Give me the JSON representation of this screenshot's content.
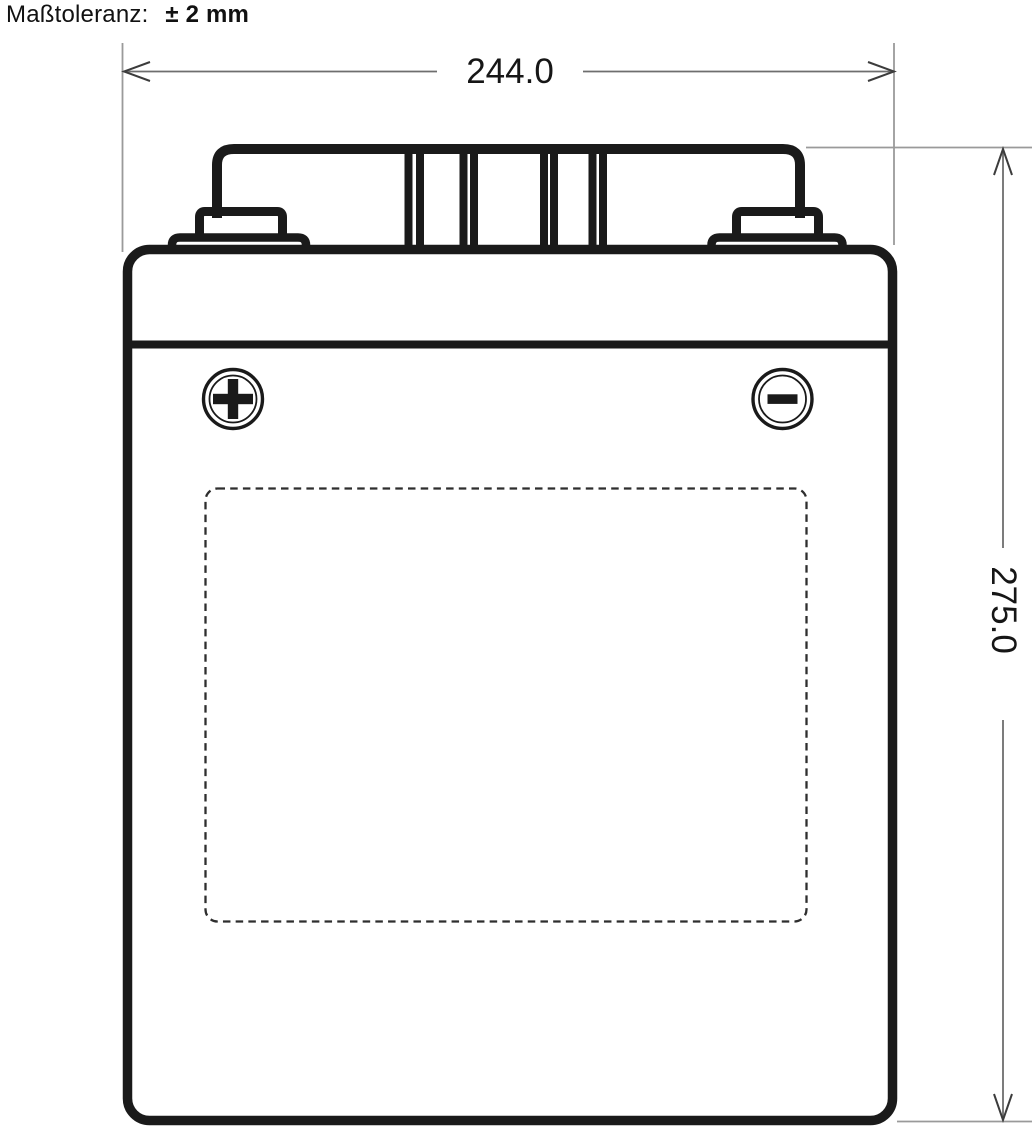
{
  "header": {
    "tolerance_label": "Maßtoleranz:",
    "tolerance_value": "± 2 mm"
  },
  "dimensions": {
    "width_value": "244.0",
    "height_value": "275.0"
  },
  "battery": {
    "positive_terminal_symbol": "+",
    "negative_terminal_symbol": "−",
    "icons": {
      "positive": "plus-icon",
      "negative": "minus-icon"
    },
    "label_area_style": "dashed-rounded-rectangle"
  },
  "colors": {
    "outline": "#1a1a1a",
    "extension_line": "#9a9a9a",
    "dimension_arrow": "#3c3c3c",
    "dashed_border": "#2e2e2e",
    "text": "#161616",
    "background": "#ffffff"
  }
}
